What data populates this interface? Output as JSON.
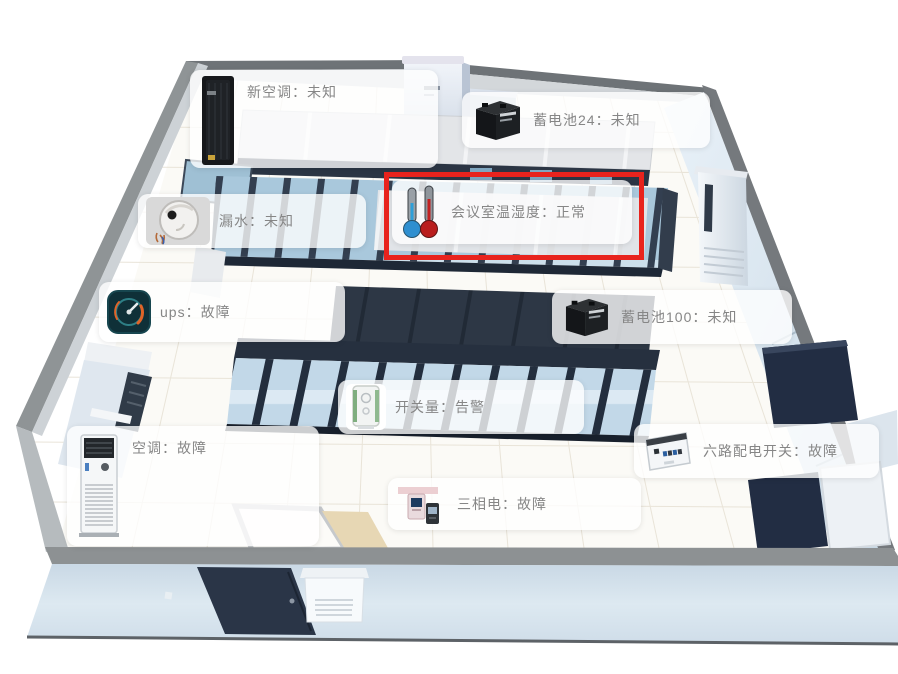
{
  "scene": {
    "colors": {
      "highlight": "#e8231d",
      "tooltip_text": "#868686",
      "rack_glass": "#a9c8dc",
      "rack_frame": "#333f50",
      "aisle_dark": "#2d3745",
      "wall_gray": "#75797d",
      "floor": "#fbfaf6",
      "outside_floor": "#d5e2ec"
    }
  },
  "devices": [
    {
      "id": "new-air-conditioner",
      "name": "新空调",
      "status": "未知",
      "label": "新空调：未知",
      "icon": "ac-tower-icon",
      "highlighted": false
    },
    {
      "id": "battery-24",
      "name": "蓄电池24",
      "status": "未知",
      "label": "蓄电池24：未知",
      "icon": "battery-icon",
      "highlighted": false
    },
    {
      "id": "meeting-room-temp-humidity",
      "name": "会议室温湿度",
      "status": "正常",
      "label": "会议室温湿度：正常",
      "icon": "thermometer-icon",
      "highlighted": true
    },
    {
      "id": "water-leak",
      "name": "漏水",
      "status": "未知",
      "label": "漏水：未知",
      "icon": "leak-sensor-icon",
      "highlighted": false
    },
    {
      "id": "ups",
      "name": "ups",
      "status": "故障",
      "label": "ups：故障",
      "icon": "gauge-icon",
      "highlighted": false
    },
    {
      "id": "battery-100",
      "name": "蓄电池100",
      "status": "未知",
      "label": "蓄电池100：未知",
      "icon": "battery-icon",
      "highlighted": false
    },
    {
      "id": "switch-signal",
      "name": "开关量",
      "status": "告警",
      "label": "开关量：告警",
      "icon": "switch-device-icon",
      "highlighted": false
    },
    {
      "id": "air-conditioner",
      "name": "空调",
      "status": "故障",
      "label": "空调：故障",
      "icon": "floor-ac-icon",
      "highlighted": false
    },
    {
      "id": "six-way-power-switch",
      "name": "六路配电开关",
      "status": "故障",
      "label": "六路配电开关：故障",
      "icon": "distribution-box-icon",
      "highlighted": false
    },
    {
      "id": "three-phase-power",
      "name": "三相电",
      "status": "故障",
      "label": "三相电：故障",
      "icon": "power-meter-icon",
      "highlighted": false
    }
  ]
}
